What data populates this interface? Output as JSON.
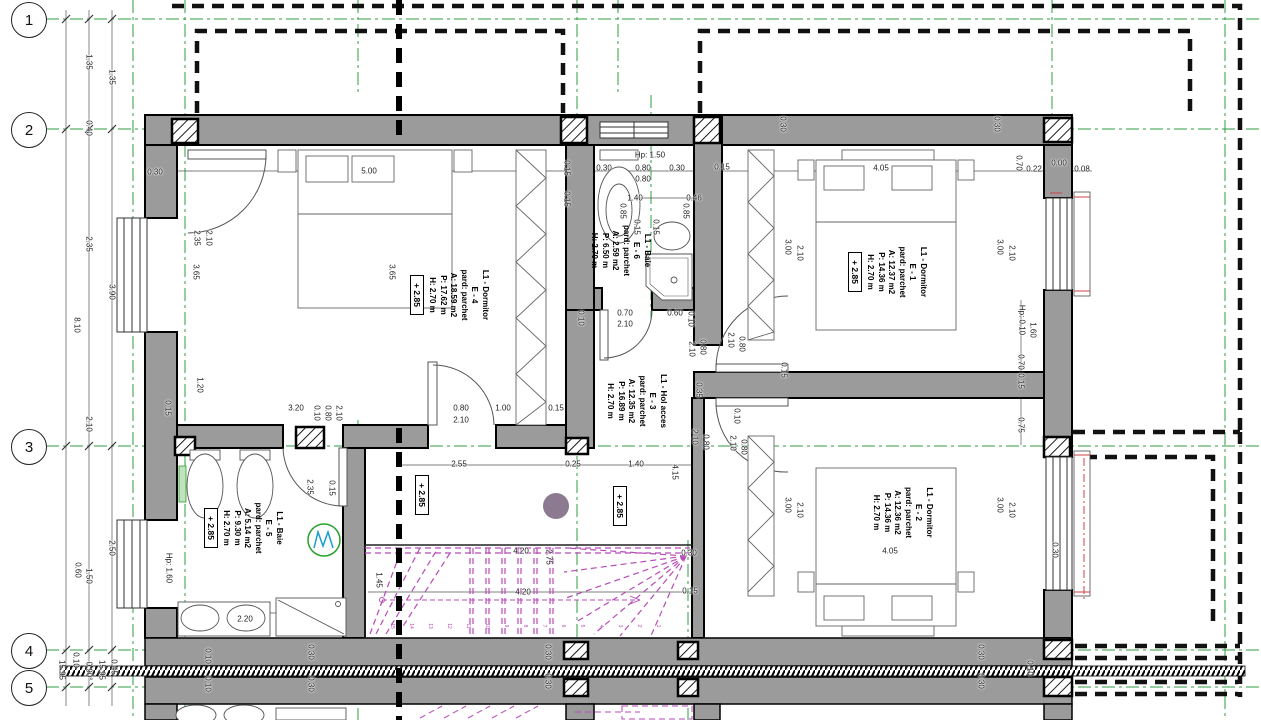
{
  "colors": {
    "wall_fill": "#9b9b9b",
    "grid_green": "#2f9e3f",
    "stairs_magenta": "#b84ab8",
    "roof_dash_black": "#111111",
    "red_accent": "#cc4040",
    "column_dot": "#8c7a90",
    "washing_machine_green": "#2aa02a",
    "washing_machine_cyan": "#18a0c8"
  },
  "grid_axes": [
    "1",
    "2",
    "3",
    "4",
    "5"
  ],
  "hall_level_markers": [
    "+ 2.85",
    "+ 2.85"
  ],
  "rooms": [
    {
      "name": "L1 - Dormitor",
      "code": "E - 4",
      "floor": "pard: parchet",
      "area": "A: 18.59 m2",
      "perimeter": "P: 17.62 m",
      "height": "H: 2.70 m",
      "level": "+ 2.85"
    },
    {
      "name": "L1 - Baie",
      "code": "E - 6",
      "floor": "pard: parchet",
      "area": "A: 2.59 m2",
      "perimeter": "P: 6.50 m",
      "height": "H: 2.70 m"
    },
    {
      "name": "L1 - Dormitor",
      "code": "E - 1",
      "floor": "pard: parchet",
      "area": "A: 12.37 m2",
      "perimeter": "P: 14.36 m",
      "height": "H: 2.70 m",
      "level": "+ 2.85"
    },
    {
      "name": "L1 - Hol acces",
      "code": "E - 3",
      "floor": "pard: parchet",
      "area": "A: 12.35 m2",
      "perimeter": "P: 16.89 m",
      "height": "H: 2.70 m"
    },
    {
      "name": "L1 - Baie",
      "code": "E - 5",
      "floor": "pard: parchet",
      "area": "A: 5.14 m2",
      "perimeter": "P: 9.30 m",
      "height": "H: 2.70 m",
      "level": "+ 2.85"
    },
    {
      "name": "L1 - Dormitor",
      "code": "E - 2",
      "floor": "pard: parchet",
      "area": "A: 12.36 m2",
      "perimeter": "P: 14.36 m",
      "height": "H: 2.70 m",
      "level": "+ 2.85"
    }
  ],
  "stairs": {
    "tread_numbers": [
      "15",
      "14",
      "13",
      "12",
      "11",
      "10",
      "9",
      "8",
      "7",
      "6",
      "5",
      "4",
      "3",
      "2",
      "1"
    ]
  },
  "dimensions": [
    {
      "t": "1.35",
      "x": 89,
      "y": 62,
      "v": true
    },
    {
      "t": "1.35",
      "x": 112,
      "y": 77,
      "v": true
    },
    {
      "t": "0.40",
      "x": 89,
      "y": 128,
      "v": true
    },
    {
      "t": "2.35",
      "x": 89,
      "y": 244,
      "v": true
    },
    {
      "t": "3.90",
      "x": 112,
      "y": 292,
      "v": true
    },
    {
      "t": "8.10",
      "x": 77,
      "y": 325,
      "v": true
    },
    {
      "t": "2.10",
      "x": 89,
      "y": 424,
      "v": true
    },
    {
      "t": "2.50",
      "x": 112,
      "y": 548,
      "v": true
    },
    {
      "t": "1.50",
      "x": 89,
      "y": 576,
      "v": true
    },
    {
      "t": "0.60",
      "x": 78,
      "y": 570,
      "v": true
    },
    {
      "t": "0.10",
      "x": 76,
      "y": 660,
      "v": true
    },
    {
      "t": "15.95",
      "x": 62,
      "y": 670,
      "v": true
    },
    {
      "t": "0.90°",
      "x": 89,
      "y": 671,
      "v": true
    },
    {
      "t": "15.95",
      "x": 102,
      "y": 670,
      "v": true
    },
    {
      "t": "0.45",
      "x": 114,
      "y": 667,
      "v": true
    },
    {
      "t": "0.30",
      "x": 155,
      "y": 172
    },
    {
      "t": "5.00",
      "x": 369,
      "y": 171
    },
    {
      "t": "2.35",
      "x": 197,
      "y": 238,
      "v": true
    },
    {
      "t": "2.10",
      "x": 209,
      "y": 238,
      "v": true
    },
    {
      "t": "3.65",
      "x": 196,
      "y": 272,
      "v": true
    },
    {
      "t": "3.65",
      "x": 392,
      "y": 272,
      "v": true
    },
    {
      "t": "1.20",
      "x": 200,
      "y": 385,
      "v": true
    },
    {
      "t": "3.20",
      "x": 296,
      "y": 408
    },
    {
      "t": "0.10",
      "x": 317,
      "y": 413,
      "v": true
    },
    {
      "t": "0.80",
      "x": 328,
      "y": 413,
      "v": true
    },
    {
      "t": "2.10",
      "x": 339,
      "y": 413,
      "v": true
    },
    {
      "t": "0.80",
      "x": 461,
      "y": 408
    },
    {
      "t": "2.10",
      "x": 461,
      "y": 420
    },
    {
      "t": "1.00",
      "x": 503,
      "y": 408
    },
    {
      "t": "0.15",
      "x": 556,
      "y": 408
    },
    {
      "t": "0.15",
      "x": 168,
      "y": 408,
      "v": true
    },
    {
      "t": "0.15",
      "x": 567,
      "y": 168,
      "v": true
    },
    {
      "t": "0.15",
      "x": 567,
      "y": 199,
      "v": true
    },
    {
      "t": "Hp: 1.50",
      "x": 650,
      "y": 155
    },
    {
      "t": "0.80",
      "x": 643,
      "y": 168
    },
    {
      "t": "0.80",
      "x": 643,
      "y": 179
    },
    {
      "t": "0.30",
      "x": 604,
      "y": 168
    },
    {
      "t": "0.30",
      "x": 677,
      "y": 168
    },
    {
      "t": "1.40",
      "x": 635,
      "y": 198
    },
    {
      "t": "0.46",
      "x": 694,
      "y": 198
    },
    {
      "t": "0.85",
      "x": 623,
      "y": 211,
      "v": true
    },
    {
      "t": "0.85",
      "x": 686,
      "y": 211,
      "v": true
    },
    {
      "t": "0.15",
      "x": 637,
      "y": 227,
      "v": true
    },
    {
      "t": "0.15",
      "x": 656,
      "y": 227,
      "v": true
    },
    {
      "t": "0.70",
      "x": 625,
      "y": 313
    },
    {
      "t": "2.10",
      "x": 625,
      "y": 324
    },
    {
      "t": "0.60",
      "x": 675,
      "y": 313
    },
    {
      "t": "0.10",
      "x": 581,
      "y": 318,
      "v": true
    },
    {
      "t": "0.15",
      "x": 722,
      "y": 167
    },
    {
      "t": "4.05",
      "x": 881,
      "y": 168
    },
    {
      "t": "0.30",
      "x": 783,
      "y": 124,
      "v": true
    },
    {
      "t": "0.30",
      "x": 997,
      "y": 124,
      "v": true
    },
    {
      "t": "0.70",
      "x": 1019,
      "y": 163,
      "v": true
    },
    {
      "t": "0.22",
      "x": 1034,
      "y": 169
    },
    {
      "t": "0.00",
      "x": 1059,
      "y": 163
    },
    {
      "t": "0.08",
      "x": 1082,
      "y": 169
    },
    {
      "t": "3.00",
      "x": 788,
      "y": 247,
      "v": true
    },
    {
      "t": "2.10",
      "x": 800,
      "y": 253,
      "v": true
    },
    {
      "t": "3.00",
      "x": 1000,
      "y": 247,
      "v": true
    },
    {
      "t": "2.10",
      "x": 1012,
      "y": 253,
      "v": true
    },
    {
      "t": "Hp: 0.10",
      "x": 1022,
      "y": 320,
      "v": true
    },
    {
      "t": "1.60",
      "x": 1033,
      "y": 330,
      "v": true
    },
    {
      "t": "0.70",
      "x": 1021,
      "y": 362,
      "v": true
    },
    {
      "t": "0.15",
      "x": 1021,
      "y": 381,
      "v": true
    },
    {
      "t": "0.75",
      "x": 1021,
      "y": 425,
      "v": true
    },
    {
      "t": "0.10",
      "x": 691,
      "y": 319,
      "v": true
    },
    {
      "t": "2.10",
      "x": 692,
      "y": 349,
      "v": true
    },
    {
      "t": "0.80",
      "x": 703,
      "y": 347,
      "v": true
    },
    {
      "t": "2.10",
      "x": 731,
      "y": 340,
      "v": true
    },
    {
      "t": "0.80",
      "x": 742,
      "y": 344,
      "v": true
    },
    {
      "t": "0.15",
      "x": 784,
      "y": 370,
      "v": true
    },
    {
      "t": "0.35",
      "x": 699,
      "y": 390,
      "v": true
    },
    {
      "t": "0.10",
      "x": 737,
      "y": 416,
      "v": true
    },
    {
      "t": "2.10",
      "x": 695,
      "y": 437,
      "v": true
    },
    {
      "t": "0.80",
      "x": 706,
      "y": 442,
      "v": true
    },
    {
      "t": "2.10",
      "x": 733,
      "y": 443,
      "v": true
    },
    {
      "t": "0.80",
      "x": 744,
      "y": 447,
      "v": true
    },
    {
      "t": "2.55",
      "x": 459,
      "y": 464
    },
    {
      "t": "0.25",
      "x": 573,
      "y": 464
    },
    {
      "t": "1.40",
      "x": 636,
      "y": 464
    },
    {
      "t": "4.15",
      "x": 675,
      "y": 472,
      "v": true
    },
    {
      "t": "4.20",
      "x": 521,
      "y": 551
    },
    {
      "t": "4.20",
      "x": 523,
      "y": 592
    },
    {
      "t": "2.75",
      "x": 549,
      "y": 557,
      "v": true
    },
    {
      "t": "1.45",
      "x": 379,
      "y": 580,
      "v": true
    },
    {
      "t": "0.30",
      "x": 689,
      "y": 553
    },
    {
      "t": "0.15",
      "x": 690,
      "y": 591
    },
    {
      "t": "2.35",
      "x": 310,
      "y": 487,
      "v": true
    },
    {
      "t": "0.15",
      "x": 332,
      "y": 488,
      "v": true
    },
    {
      "t": "Hp: 1.60",
      "x": 169,
      "y": 568,
      "v": true
    },
    {
      "t": "2.20",
      "x": 245,
      "y": 619
    },
    {
      "t": "0.10",
      "x": 208,
      "y": 656,
      "v": true
    },
    {
      "t": "0.30",
      "x": 311,
      "y": 652,
      "v": true
    },
    {
      "t": "0.10",
      "x": 208,
      "y": 684,
      "v": true
    },
    {
      "t": "0.30",
      "x": 311,
      "y": 684,
      "v": true
    },
    {
      "t": "3.00",
      "x": 788,
      "y": 505,
      "v": true
    },
    {
      "t": "2.10",
      "x": 800,
      "y": 510,
      "v": true
    },
    {
      "t": "3.00",
      "x": 1000,
      "y": 505,
      "v": true
    },
    {
      "t": "2.10",
      "x": 1012,
      "y": 510,
      "v": true
    },
    {
      "t": "4.05",
      "x": 890,
      "y": 551
    },
    {
      "t": "0.30",
      "x": 1055,
      "y": 550,
      "v": true
    },
    {
      "t": "0.30",
      "x": 548,
      "y": 652,
      "v": true
    },
    {
      "t": "0.30",
      "x": 548,
      "y": 681,
      "v": true
    },
    {
      "t": "0.30",
      "x": 981,
      "y": 652,
      "v": true
    },
    {
      "t": "0.30",
      "x": 981,
      "y": 681,
      "v": true
    },
    {
      "t": "0.10",
      "x": 1030,
      "y": 668,
      "v": true
    }
  ]
}
